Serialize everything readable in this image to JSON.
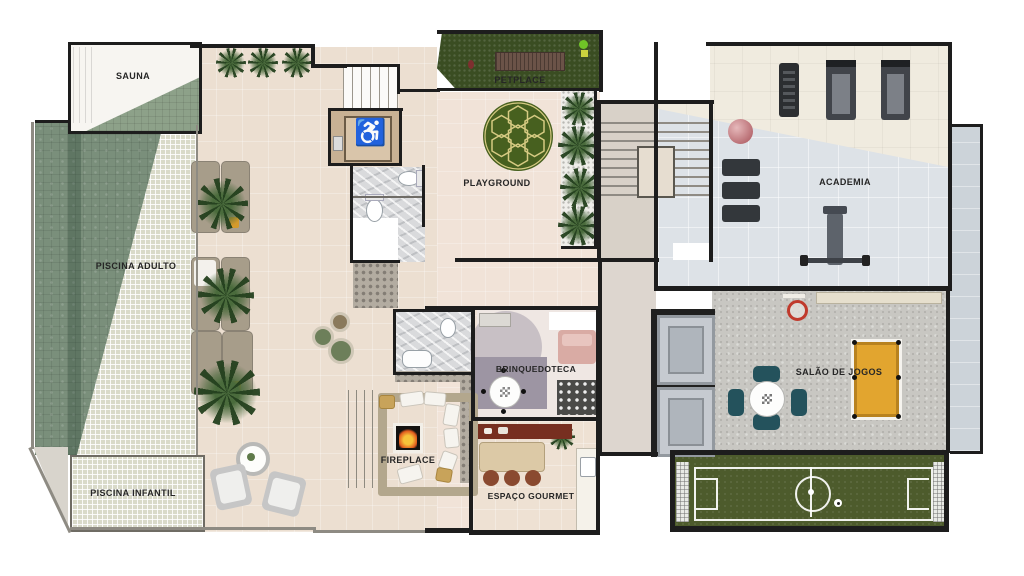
{
  "document": {
    "type": "residential-building leisure floor plan (top view render)",
    "language": "pt-BR"
  },
  "rooms": {
    "sauna": {
      "label": "SAUNA"
    },
    "piscina_adulto": {
      "label": "PISCINA ADULTO"
    },
    "piscina_infantil": {
      "label": "PISCINA INFANTIL"
    },
    "petplace": {
      "label": "PETPLACE"
    },
    "playground": {
      "label": "PLAYGROUND"
    },
    "academia": {
      "label": "ACADEMIA"
    },
    "brinquedoteca": {
      "label": "BRINQUEDOTECA"
    },
    "fireplace": {
      "label": "FIREPLACE"
    },
    "espaco_gourmet": {
      "label": "ESPAÇO GOURMET"
    },
    "salao_de_jogos": {
      "label": "SALÃO DE JOGOS"
    }
  },
  "icons": {
    "accessible_wc": "♿"
  },
  "colors": {
    "wall_dark": "#1d1d1d",
    "deck_cream": "#ecdfd1",
    "pool_green": "#7a8f7b",
    "kids_pool": "#d9dac9",
    "turf_green": "#3a4d22",
    "soccer_field_green": "#4d5b2c",
    "gym_floor_gray": "#dde2e7",
    "games_concrete": "#c8c7c2",
    "pool_table_yellow": "#e2a52f",
    "game_chair_teal": "#24525c",
    "accessible_blue": "#2d34cf",
    "gourmet_counter_maroon": "#772f20"
  }
}
